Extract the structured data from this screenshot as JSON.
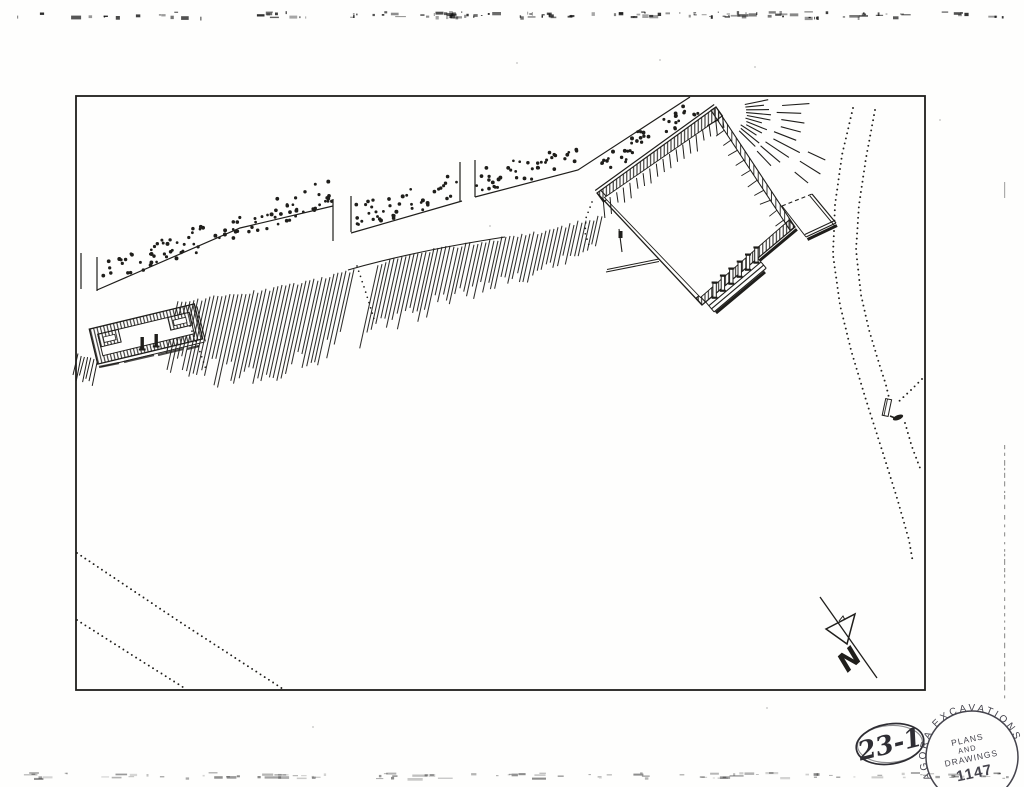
{
  "labels": {
    "north": "N",
    "sheet_number": "23-1"
  },
  "stamp": {
    "ring": "* AGORA EXCAVATIONS",
    "line1": "PLANS",
    "line2": "AND",
    "line3": "DRAWINGS",
    "number": "1147"
  },
  "colors": {
    "paper": "#fefefd",
    "ink": "#1f1e1b",
    "stamp_ink": "#45444d",
    "pencil": "#2e2d33"
  }
}
